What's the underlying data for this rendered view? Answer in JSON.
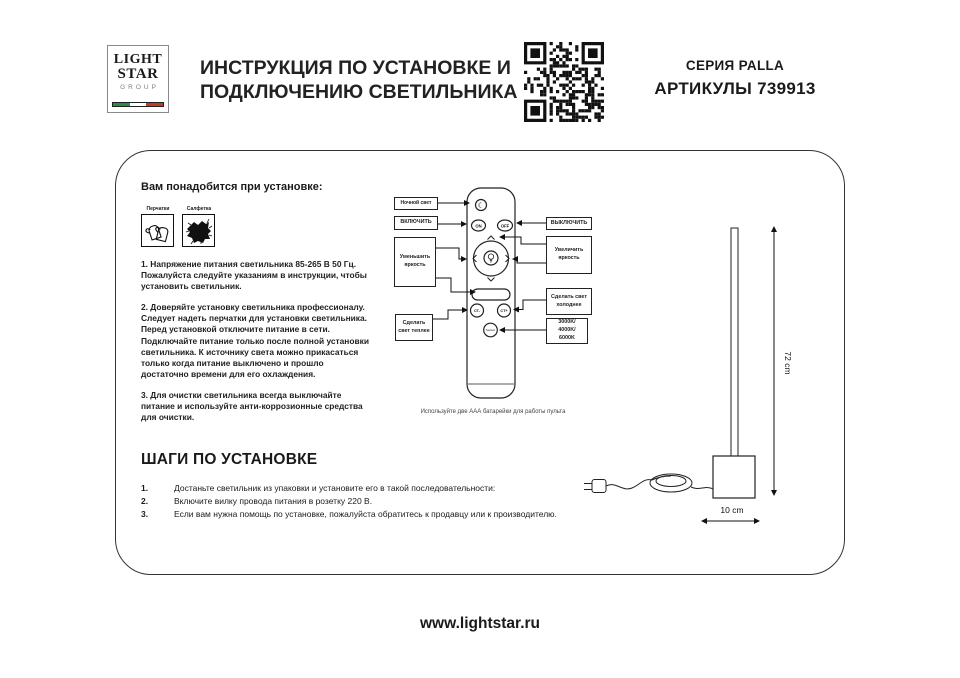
{
  "header": {
    "logo": {
      "line1": "LIGHT",
      "line2": "STAR",
      "line3": "GROUP"
    },
    "title_line1": "ИНСТРУКЦИЯ ПО УСТАНОВКЕ И",
    "title_line2": "ПОДКЛЮЧЕНИЮ СВЕТИЛЬНИКА",
    "series": "СЕРИЯ PALLA",
    "articles": "АРТИКУЛЫ 739913"
  },
  "panel": {
    "needs_title": "Вам понадобится при установке:",
    "tools": [
      {
        "label": "Перчатки"
      },
      {
        "label": "Салфетка"
      }
    ],
    "paragraphs": [
      "1. Напряжение питания светильника 85-265 В 50 Гц. Пожалуйста следуйте указаниям в инструкции, чтобы установить светильник.",
      "2. Доверяйте установку светильника профессионалу. Следует надеть перчатки для установки светильника. Перед установкой отключите питание в сети. Подключайте питание только после полной установки светильника. К источнику света можно прикасаться только когда питание выключено и прошло достаточно времени для его охлаждения.",
      "3. Для очистки светильника всегда выключайте питание и используйте анти-коррозионные средства для очистки."
    ]
  },
  "remote": {
    "labels": {
      "night": "Ночной свет",
      "on": "ВКЛЮЧИТЬ",
      "off": "ВЫКЛЮЧИТЬ",
      "dim": "Уменьшить яркость",
      "bright": "Увеличить яркость",
      "warm": "Сделать свет теплее",
      "cold": "Сделать свет холоднее",
      "kelvin": "3000K/\n4000K/\n6000K"
    },
    "buttons": {
      "on": "ON",
      "off": "OFF",
      "ct_minus": "CT-",
      "ct_plus": "CT+",
      "section": "Section"
    },
    "icons": {
      "night_light": "☾"
    },
    "caption": "Используйте две ААА батарейки для работы пульта"
  },
  "lamp": {
    "height_label": "72 cm",
    "width_label": "10 cm"
  },
  "steps": {
    "title": "ШАГИ ПО УСТАНОВКЕ",
    "items": [
      {
        "num": "1.",
        "text": "Достаньте светильник из упаковки и установите его в такой последовательности:"
      },
      {
        "num": "2.",
        "text": "Включите вилку провода питания в розетку 220 В."
      },
      {
        "num": "3.",
        "text": "Если вам нужна помощь по установке, пожалуйста обратитесь к продавцу или к производителю."
      }
    ]
  },
  "footer": {
    "url": "www.lightstar.ru"
  },
  "brand_colors": {
    "flag_green": "#2e8b3d",
    "flag_red": "#c0392b",
    "ink": "#1a1a1a"
  }
}
